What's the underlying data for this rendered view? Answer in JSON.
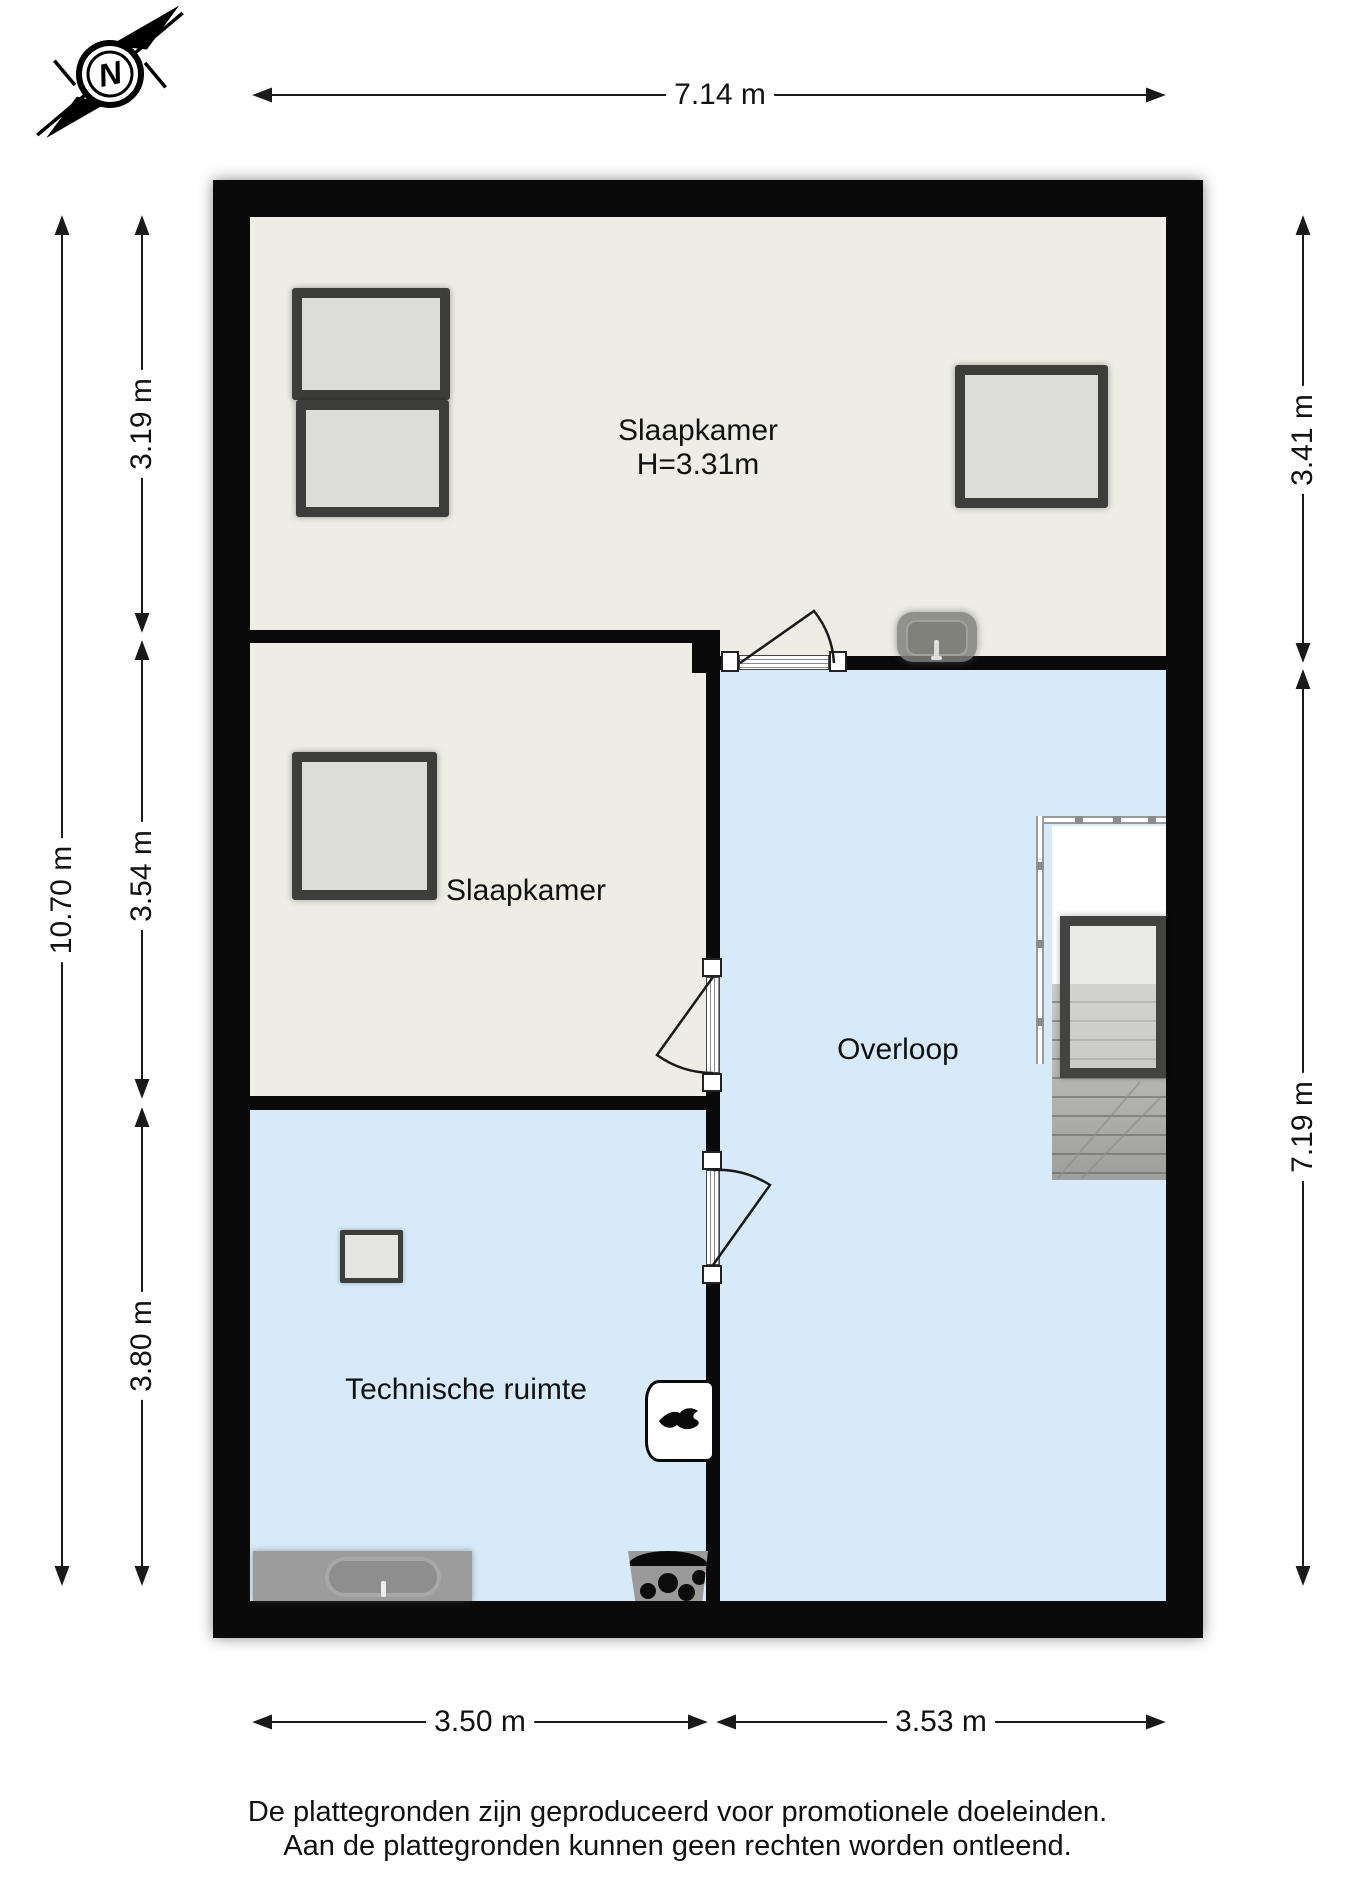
{
  "compass": {
    "label": "N"
  },
  "rooms": {
    "slaapkamer1": {
      "label": "Slaapkamer",
      "height_label": "H=3.31m"
    },
    "slaapkamer2": {
      "label": "Slaapkamer"
    },
    "overloop": {
      "label": "Overloop"
    },
    "technische_ruimte": {
      "label": "Technische ruimte"
    }
  },
  "dimensions": {
    "top_width": "7.14 m",
    "left_total_height": "10.70 m",
    "left_room1_height": "3.19 m",
    "left_room2_height": "3.54 m",
    "left_room3_height": "3.80 m",
    "right_room1_height": "3.41 m",
    "right_overloop_height": "7.19 m",
    "bottom_left_width": "3.50 m",
    "bottom_right_width": "3.53 m"
  },
  "footer": {
    "line1": "De plattegronden zijn geproduceerd voor promotionele doeleinden.",
    "line2": "Aan de plattegronden kunnen geen rechten worden ontleend."
  },
  "colors": {
    "wall": "#0a0a0a",
    "room_cream": "#edede5",
    "room_blue": "#d6eafa",
    "window_frame": "#3d3d3b",
    "window_glass": "#dcdcd8",
    "fixture_gray": "#9c9c9c"
  }
}
